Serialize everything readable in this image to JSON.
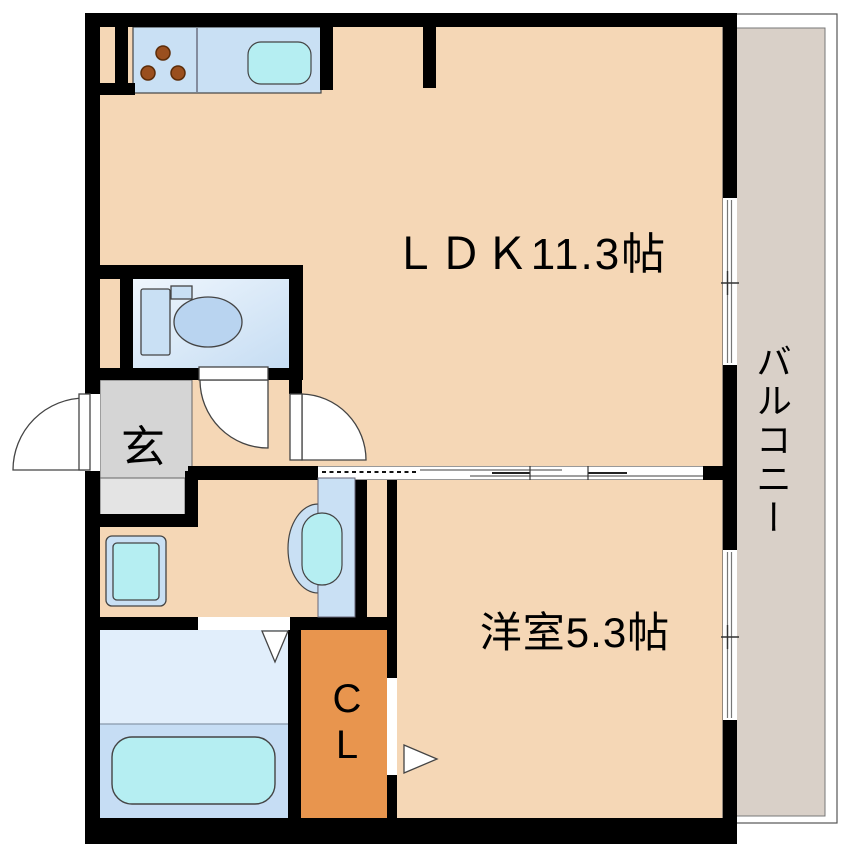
{
  "floorplan": {
    "title": "1LDK apartment floor plan",
    "labels": {
      "ldk": "ＬＤＫ11.3帖",
      "western_room": "洋室5.3帖",
      "entrance": "玄",
      "closet_top": "C",
      "closet_bottom": "L",
      "balcony": "バルコニー"
    },
    "fixtures": [
      "kitchen-counter",
      "stove-burners-icon",
      "kitchen-sink-icon",
      "toilet-icon",
      "washing-machine-icon",
      "washbasin-icon",
      "bathtub-icon",
      "door-swing-arc",
      "sliding-door",
      "window"
    ],
    "colors": {
      "floor_peach": "#f5d7b6",
      "wall_black": "#000000",
      "water_blue": "#c9e0f4",
      "fixture_cyan": "#b5eef2",
      "toilet_bowl_blue": "#b9d4f0",
      "bath_upper": "#e1eefb",
      "bath_lower": "#c6ddf4",
      "closet_orange": "#e8954e",
      "entrance_gray": "#d5d5d5",
      "entrance_step_gray": "#e4e4e4",
      "balcony_gray": "#d9d0c8",
      "burner_brown": "#9a4f1e",
      "outline_dark": "#444444",
      "hairline_gray": "#999999"
    }
  }
}
